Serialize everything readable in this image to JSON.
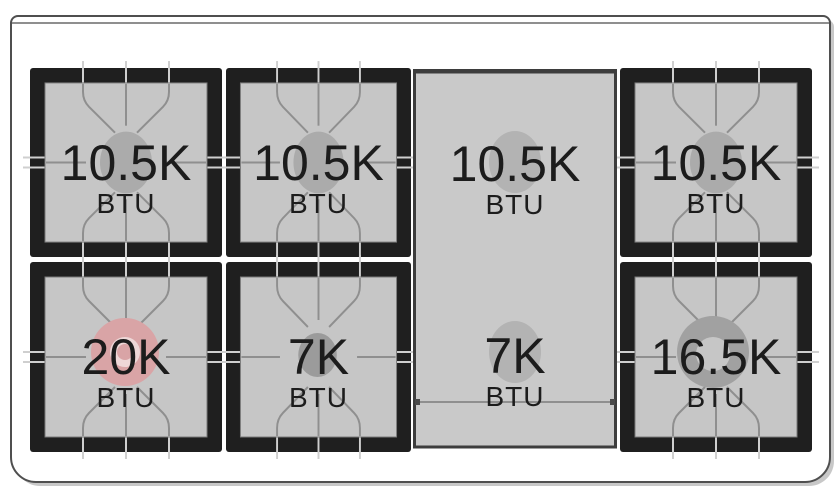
{
  "diagram": {
    "type": "range-cooktop-burner-layout",
    "burners": [
      {
        "position": "left-rear",
        "value": "10.5K",
        "unit": "BTU"
      },
      {
        "position": "center-left-rear",
        "value": "10.5K",
        "unit": "BTU"
      },
      {
        "position": "griddle-rear",
        "value": "10.5K",
        "unit": "BTU"
      },
      {
        "position": "right-rear",
        "value": "10.5K",
        "unit": "BTU"
      },
      {
        "position": "left-front",
        "value": "20K",
        "unit": "BTU"
      },
      {
        "position": "center-left-front",
        "value": "7K",
        "unit": "BTU"
      },
      {
        "position": "griddle-front",
        "value": "7K",
        "unit": "BTU"
      },
      {
        "position": "right-front",
        "value": "16.5K",
        "unit": "BTU"
      }
    ],
    "colors": {
      "grate_black": "#1f1f1f",
      "burner_bed_gray": "#c6c6c6",
      "griddle_gray": "#c9c9c9",
      "burner_cap_gray": "#ababab",
      "highlight_pink": "#d9a4a6",
      "grate_line_gray": "#8f8f8f",
      "frame_gray": "#4f4f4f",
      "label_text": "#1c1c1c"
    }
  }
}
